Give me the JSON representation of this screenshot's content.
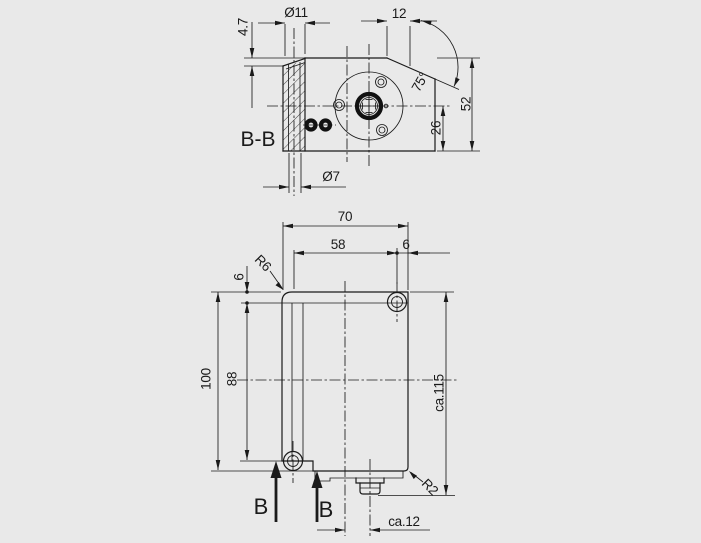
{
  "colors": {
    "background": "#e9e9e9",
    "line": "#1a1a1a"
  },
  "section_view": {
    "label": "B-B",
    "dims": {
      "counterbore_depth": "4.7",
      "counterbore_dia": "Ø11",
      "top_offset": "12",
      "chamfer_angle": "75°",
      "height": "52",
      "center_height": "26",
      "through_hole_dia": "Ø7"
    }
  },
  "front_view": {
    "dims": {
      "width": "70",
      "hole_spacing": "58",
      "hole_edge_offset": "6",
      "top_edge_offset": "6",
      "corner_radius": "R6",
      "body_height": "100",
      "hole_height": "88",
      "overall_height": "ca.115",
      "bottom_radius": "R2",
      "connector_offset": "ca.12"
    },
    "section_marker": "B"
  }
}
